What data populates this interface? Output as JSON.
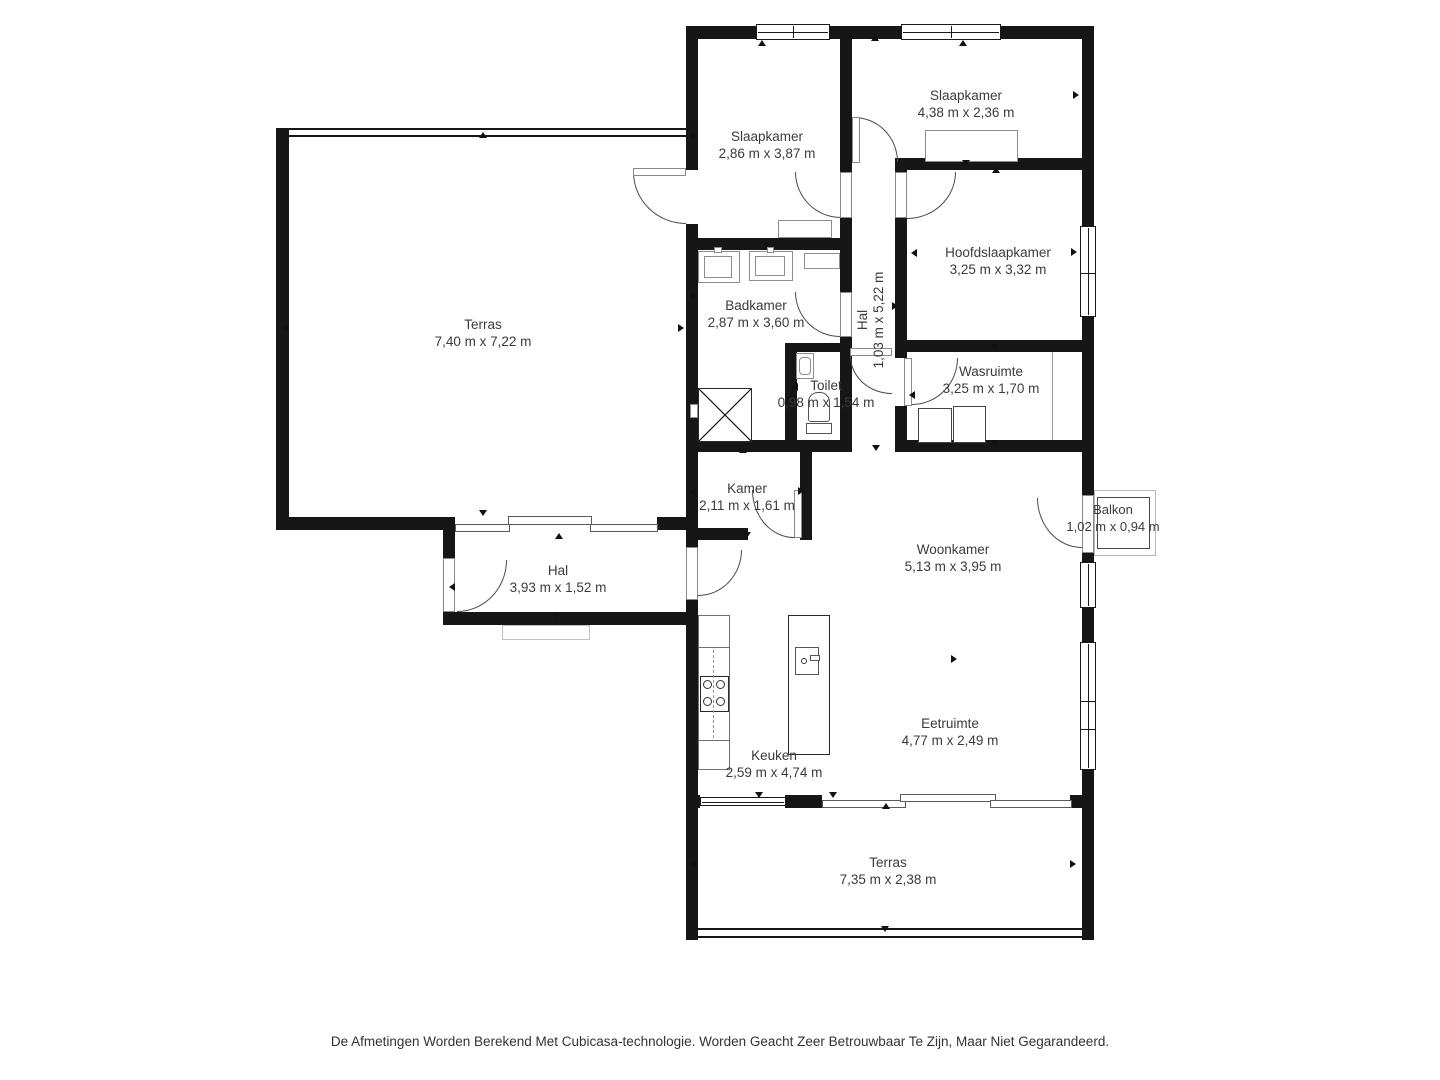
{
  "page": {
    "background": "#ffffff",
    "footer_disclaimer": "De Afmetingen Worden Berekend Met Cubicasa-technologie. Worden Geacht Zeer Betrouwbaar Te Zijn, Maar Niet Gegarandeerd."
  },
  "plan": {
    "type": "floorplan",
    "colors": {
      "wall": "#161616",
      "label_text": "#3b3b3b",
      "fixture_line": "#8d8d8d"
    },
    "rooms": [
      {
        "name": "Slaapkamer",
        "dims": "2,86 m x 3,87 m"
      },
      {
        "name": "Slaapkamer",
        "dims": "4,38 m x 2,36 m"
      },
      {
        "name": "Hoofdslaapkamer",
        "dims": "3,25 m x 3,32 m"
      },
      {
        "name": "Hal",
        "dims": "1,03 m x 5,22 m"
      },
      {
        "name": "Badkamer",
        "dims": "2,87 m x 3,60 m"
      },
      {
        "name": "Toilet",
        "dims": "0,98 m x 1,54 m"
      },
      {
        "name": "Wasruimte",
        "dims": "3,25 m x 1,70 m"
      },
      {
        "name": "Kamer",
        "dims": "2,11 m x 1,61 m"
      },
      {
        "name": "Hal",
        "dims": "3,93 m x 1,52 m"
      },
      {
        "name": "Terras",
        "dims": "7,40 m x 7,22 m"
      },
      {
        "name": "Woonkamer",
        "dims": "5,13 m x 3,95 m"
      },
      {
        "name": "Keuken",
        "dims": "2,59 m x 4,74 m"
      },
      {
        "name": "Eetruimte",
        "dims": "4,77 m x 2,49 m"
      },
      {
        "name": "Terras",
        "dims": "7,35 m x 2,38 m"
      },
      {
        "name": "Balkon",
        "dims": "1,02 m x 0,94 m"
      }
    ]
  }
}
